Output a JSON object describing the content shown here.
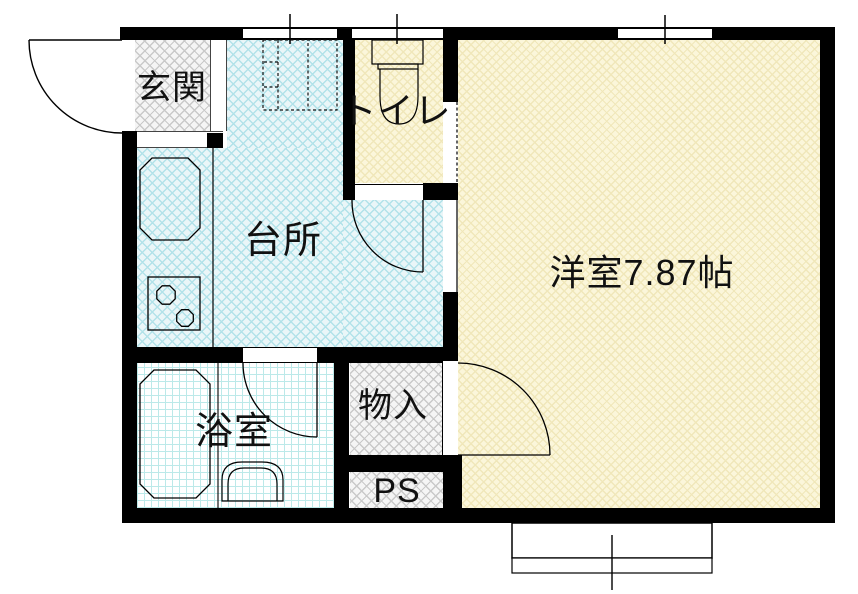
{
  "rooms": {
    "genkan": {
      "label": "玄関"
    },
    "kitchen": {
      "label": "台所"
    },
    "toilet": {
      "label": "トイレ"
    },
    "western_room": {
      "label": "洋室7.87帖"
    },
    "bathroom": {
      "label": "浴室"
    },
    "storage": {
      "label": "物入"
    },
    "pipe_space": {
      "label": "PS"
    }
  },
  "colors": {
    "wall": "#000000",
    "kitchen_base": "#eaf6f8",
    "kitchen_line": "#b2e2e9",
    "yellow_base": "#fbf6da",
    "yellow_line": "#f0e7ba",
    "gray_base": "#f5f5f5",
    "gray_line": "#c9c9c9",
    "bath_base": "#ffffff",
    "bath_line": "#bce9e9",
    "outline": "#000000"
  }
}
